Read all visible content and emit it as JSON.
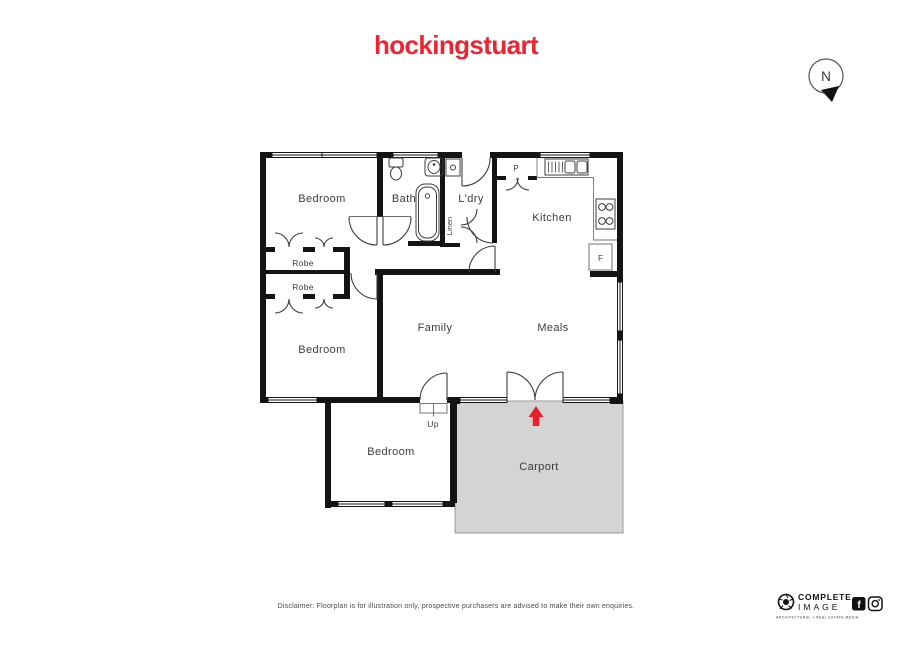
{
  "brand": {
    "name": "hockingstuart",
    "color": "#ed2533"
  },
  "compass": {
    "label": "N"
  },
  "rooms": {
    "bedroom1": "Bedroom",
    "bath": "Bath",
    "ldry": "L'dry",
    "kitchen": "Kitchen",
    "robe1": "Robe",
    "robe2": "Robe",
    "family": "Family",
    "meals": "Meals",
    "bedroom2": "Bedroom",
    "bedroom3": "Bedroom",
    "carport": "Carport",
    "linen": "Linen",
    "pantry": "P",
    "fridge": "F",
    "up": "Up"
  },
  "colors": {
    "carport_fill": "#d4d4d4",
    "carport_border": "#9a9a9a",
    "entry_arrow": "#e8212d",
    "wall": "#141414"
  },
  "footer": {
    "disclaimer": "Disclaimer: Floorplan is for illustration only, prospective purchasers are advised to make their own enquiries."
  },
  "credit": {
    "line1": "COMPLETE",
    "line2": "IMAGE",
    "tagline": "ARCHITECTURAL + REAL ESTATE MEDIA",
    "fb_letter": "f",
    "social": [
      "facebook",
      "instagram"
    ]
  }
}
